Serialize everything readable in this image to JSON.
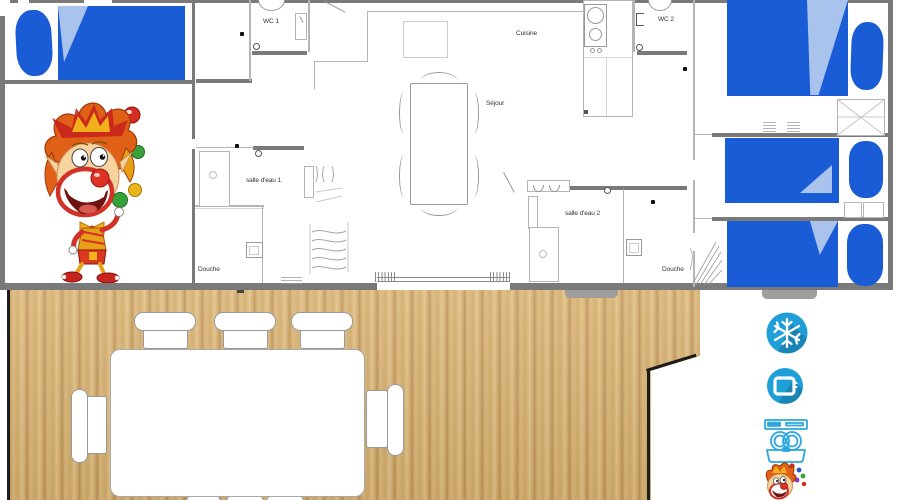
{
  "title": "Mobile home floor plan with terrace",
  "plan": {
    "rooms": {
      "wc1": "WC 1",
      "wc2": "WC 2",
      "kitchen": "Cuisine",
      "living": "Séjour",
      "bathroom1": "salle d'eau 1",
      "bathroom2": "salle d'eau 2",
      "shower_left": "Douche",
      "shower_right": "Douche"
    },
    "beds": {
      "double_beds": 2,
      "single_beds": 2
    },
    "colors": {
      "bed_blue": "#1a5cd6",
      "bed_fold": "#a9c3ec",
      "wall_gray": "#7a7a7a",
      "deck_wood": "#d4ae6e",
      "icon_blue": "#1f9fd8"
    }
  },
  "deck": {
    "tables": 1,
    "chairs": 8
  },
  "amenities": [
    {
      "icon": "air-conditioning-icon"
    },
    {
      "icon": "tv-icon"
    },
    {
      "icon": "dishwasher-icon"
    },
    {
      "icon": "clown-mascot-icon"
    }
  ],
  "mascot": "juggling-clown"
}
